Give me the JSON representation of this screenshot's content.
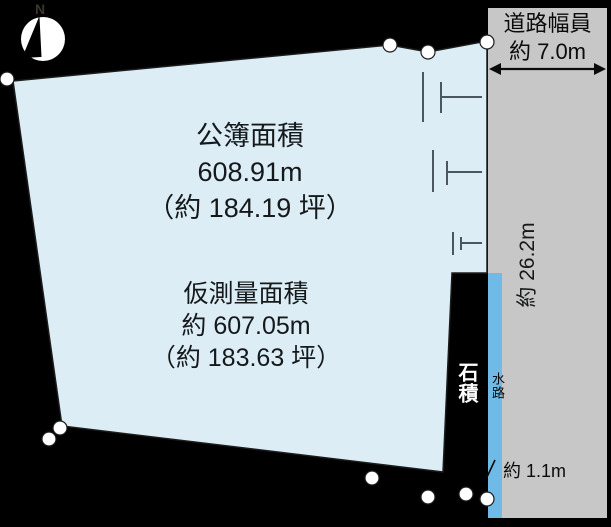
{
  "diagram": {
    "compass": {
      "north_label": "N"
    },
    "road": {
      "width_line1": "道路幅員",
      "width_line2": "約 7.0m",
      "frontage_length": "約 26.2m",
      "waterway_width": "約 1.1m"
    },
    "waterway_label": "水路",
    "stone_wall_label": "石積",
    "registered_area": {
      "title": "公簿面積",
      "area": "608.91m",
      "tsubo": "（約 184.19 坪）"
    },
    "survey_area": {
      "title": "仮測量面積",
      "area": "約 607.05m",
      "tsubo": "（約 183.63 坪）"
    },
    "colors": {
      "background": "#000000",
      "land_fill": "#dcedf5",
      "road_fill": "#c7c7c7",
      "water_fill": "#70bae7",
      "survey_point": "#ffffff"
    }
  }
}
